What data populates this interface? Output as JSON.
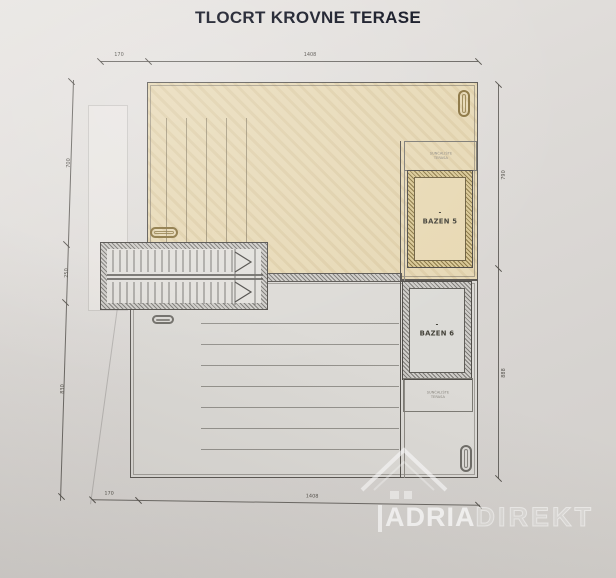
{
  "title": "TLOCRT KROVNE TERASE",
  "plan": {
    "pools": [
      {
        "label": "BAZEN 5",
        "marker": "-"
      },
      {
        "label": "BAZEN 6",
        "marker": "-"
      }
    ],
    "annotation_boxes": [
      {
        "line1": "SUNČALIŠTE",
        "line2": "TERASA"
      },
      {
        "line1": "SUNČALIŠTE",
        "line2": "TERASA"
      }
    ],
    "dimensions": {
      "top": [
        "170",
        "1408"
      ],
      "bottom": [
        "170",
        "1408"
      ],
      "left": [
        "700",
        "250",
        "830"
      ],
      "right": [
        "790",
        "888"
      ]
    }
  },
  "watermark": {
    "brand_bold": "ADRIA",
    "brand_light": "DIREKT"
  },
  "icons": {
    "watermark_icon": "house-roof-icon",
    "drain_symbols": "drain-pill-icon",
    "stair_arrows": "direction-chevron-icon"
  },
  "colors": {
    "paper": "#dcd9d6",
    "terrace_upper_fill": "#e7d9b6",
    "terrace_lower_fill": "#dcdad6",
    "pool5_frame_hatch": "#8d7a48",
    "pool6_frame_hatch": "#7e7c78",
    "drawing_line": "#55524d",
    "title_text": "#0f1220",
    "watermark": "#ffffff"
  }
}
